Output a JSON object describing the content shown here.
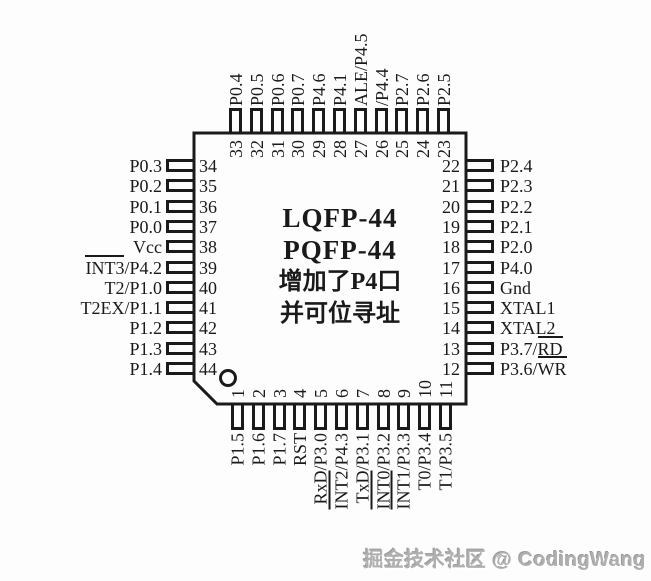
{
  "title_lines": [
    "LQFP-44",
    "PQFP-44",
    "增加了P4口",
    "并可位寻址"
  ],
  "watermark": "掘金技术社区 @ CodingWang",
  "colors": {
    "line": "#1a1a1a",
    "background": "#fdfdfd",
    "watermark_gray": "#afafaf"
  },
  "pins": {
    "top": [
      {
        "num": "33",
        "parts": [
          {
            "t": "P0.4"
          }
        ]
      },
      {
        "num": "32",
        "parts": [
          {
            "t": "P0.5"
          }
        ]
      },
      {
        "num": "31",
        "parts": [
          {
            "t": "P0.6"
          }
        ]
      },
      {
        "num": "30",
        "parts": [
          {
            "t": "P0.7"
          }
        ]
      },
      {
        "num": "29",
        "parts": [
          {
            "t": "P4.6"
          }
        ]
      },
      {
        "num": "28",
        "parts": [
          {
            "t": "P4.1"
          }
        ]
      },
      {
        "num": "27",
        "parts": [
          {
            "t": "ALE/P4.5"
          }
        ]
      },
      {
        "num": "26",
        "parts": [
          {
            "t": "/P4.4"
          }
        ]
      },
      {
        "num": "25",
        "parts": [
          {
            "t": "P2.7"
          }
        ]
      },
      {
        "num": "24",
        "parts": [
          {
            "t": "P2.6"
          }
        ]
      },
      {
        "num": "23",
        "parts": [
          {
            "t": "P2.5"
          }
        ]
      }
    ],
    "left": [
      {
        "num": "34",
        "parts": [
          {
            "t": "P0.3"
          }
        ]
      },
      {
        "num": "35",
        "parts": [
          {
            "t": "P0.2"
          }
        ]
      },
      {
        "num": "36",
        "parts": [
          {
            "t": "P0.1"
          }
        ]
      },
      {
        "num": "37",
        "parts": [
          {
            "t": "P0.0"
          }
        ]
      },
      {
        "num": "38",
        "parts": [
          {
            "t": "Vcc"
          }
        ]
      },
      {
        "num": "39",
        "parts": [
          {
            "t": "INT3",
            "ov": true
          },
          {
            "t": "/P4.2"
          }
        ]
      },
      {
        "num": "40",
        "parts": [
          {
            "t": "T2/P1.0"
          }
        ]
      },
      {
        "num": "41",
        "parts": [
          {
            "t": "T2EX/P1.1"
          }
        ]
      },
      {
        "num": "42",
        "parts": [
          {
            "t": "P1.2"
          }
        ]
      },
      {
        "num": "43",
        "parts": [
          {
            "t": "P1.3"
          }
        ]
      },
      {
        "num": "44",
        "parts": [
          {
            "t": "P1.4"
          }
        ]
      }
    ],
    "right": [
      {
        "num": "22",
        "parts": [
          {
            "t": "P2.4"
          }
        ]
      },
      {
        "num": "21",
        "parts": [
          {
            "t": "P2.3"
          }
        ]
      },
      {
        "num": "20",
        "parts": [
          {
            "t": "P2.2"
          }
        ]
      },
      {
        "num": "19",
        "parts": [
          {
            "t": "P2.1"
          }
        ]
      },
      {
        "num": "18",
        "parts": [
          {
            "t": "P2.0"
          }
        ]
      },
      {
        "num": "17",
        "parts": [
          {
            "t": "P4.0"
          }
        ]
      },
      {
        "num": "16",
        "parts": [
          {
            "t": "Gnd"
          }
        ]
      },
      {
        "num": "15",
        "parts": [
          {
            "t": "XTAL1"
          }
        ]
      },
      {
        "num": "14",
        "parts": [
          {
            "t": "XTAL2"
          }
        ]
      },
      {
        "num": "13",
        "parts": [
          {
            "t": "P3.7/"
          },
          {
            "t": "RD",
            "ov": true
          }
        ]
      },
      {
        "num": "12",
        "parts": [
          {
            "t": "P3.6/"
          },
          {
            "t": "WR",
            "ov": true
          }
        ]
      }
    ],
    "bottom": [
      {
        "num": "1",
        "parts": [
          {
            "t": "P1.5"
          }
        ]
      },
      {
        "num": "2",
        "parts": [
          {
            "t": "P1.6"
          }
        ]
      },
      {
        "num": "3",
        "parts": [
          {
            "t": "P1.7"
          }
        ]
      },
      {
        "num": "4",
        "parts": [
          {
            "t": "RST"
          }
        ]
      },
      {
        "num": "5",
        "parts": [
          {
            "t": "RxD/P3.0"
          }
        ]
      },
      {
        "num": "6",
        "parts": [
          {
            "t": "INT2",
            "ov": true
          },
          {
            "t": "/P4.3"
          }
        ]
      },
      {
        "num": "7",
        "parts": [
          {
            "t": "TxD/P3.1"
          }
        ]
      },
      {
        "num": "8",
        "parts": [
          {
            "t": "INT0",
            "ov": true
          },
          {
            "t": "/P3.2"
          }
        ]
      },
      {
        "num": "9",
        "parts": [
          {
            "t": "INT1",
            "ov": true
          },
          {
            "t": "/P3.3"
          }
        ]
      },
      {
        "num": "10",
        "parts": [
          {
            "t": "T0/P3.4"
          }
        ]
      },
      {
        "num": "11",
        "parts": [
          {
            "t": "T1/P3.5"
          }
        ]
      }
    ]
  }
}
